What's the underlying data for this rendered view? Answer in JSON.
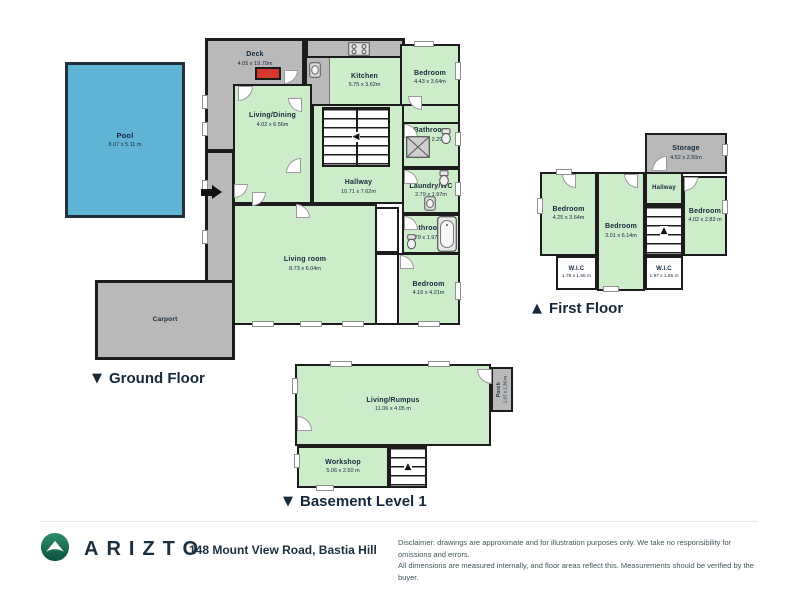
{
  "colors": {
    "room_green": "#cdecca",
    "area_gray": "#b9b9b9",
    "wall_dark": "#1c1c1c",
    "pool_blue": "#5fb4d6",
    "accent_red": "#d6382e",
    "brand_teal": "#157a5e",
    "text_dark": "#16293b"
  },
  "floors": {
    "ground": {
      "marker": "▼",
      "label": "Ground Floor",
      "rooms": {
        "pool": {
          "name": "Pool",
          "dims": "8.07 x 5.11 m"
        },
        "deck": {
          "name": "Deck",
          "dims": "4.05 x 19.70m"
        },
        "carport": {
          "name": "Carport"
        },
        "kitchen": {
          "name": "Kitchen",
          "dims": "5.75 x 3.62m"
        },
        "bedroom_top": {
          "name": "Bedroom",
          "dims": "4.43 x 3.64m"
        },
        "living_dining": {
          "name": "Living/Dining",
          "dims": "4.02 x 6.56m"
        },
        "hallway": {
          "name": "Hallway",
          "dims": "10.71 x 7.62m"
        },
        "bathroom_top": {
          "name": "Bathroom",
          "dims": "2.79 x 2.29m"
        },
        "laundry_wc": {
          "name": "Laundry/WC",
          "dims": "2.79 x 1.97m"
        },
        "bathroom_bottom": {
          "name": "Bathroom",
          "dims": "2.79 x 1.97m"
        },
        "living_room": {
          "name": "Living room",
          "dims": "8.73 x 6.04m"
        },
        "bedroom_bottom": {
          "name": "Bedroom",
          "dims": "4.16 x 4.21m"
        }
      }
    },
    "first": {
      "marker": "▲",
      "label": "First Floor",
      "rooms": {
        "storage": {
          "name": "Storage",
          "dims": "4.52 x 2.50m"
        },
        "hallway": {
          "name": "Hallway"
        },
        "bedroom_left": {
          "name": "Bedroom",
          "dims": "4.25 x 3.64m"
        },
        "bedroom_middle": {
          "name": "Bedroom",
          "dims": "3.01 x 6.14m"
        },
        "bedroom_right": {
          "name": "Bedroom",
          "dims": "4.02 x 2.83 m"
        },
        "wic_left": {
          "name": "W.I.C",
          "dims": "1.78 x 1.55 m"
        },
        "wic_right": {
          "name": "W.I.C",
          "dims": "1.97 x 1.55 m"
        }
      }
    },
    "basement": {
      "marker": "▼",
      "label": "Basement Level 1",
      "rooms": {
        "living_rumpus": {
          "name": "Living/Rumpus",
          "dims": "11.06 x 4.05 m"
        },
        "porch": {
          "name": "Porch",
          "dims": "1.97 x 1.36 m"
        },
        "workshop": {
          "name": "Workshop",
          "dims": "5.06 x 2.50 m"
        }
      }
    }
  },
  "footer": {
    "brand": "ARIZTO",
    "address": "148 Mount View Road, Bastia Hill",
    "disclaimer_line1": "Disclaimer: drawings are approximate and for illustration purposes only. We take no responsibility for omissions and errors.",
    "disclaimer_line2": "All dimensions are measured internally, and floor areas reflect this. Measurements should be verified by the buyer."
  }
}
